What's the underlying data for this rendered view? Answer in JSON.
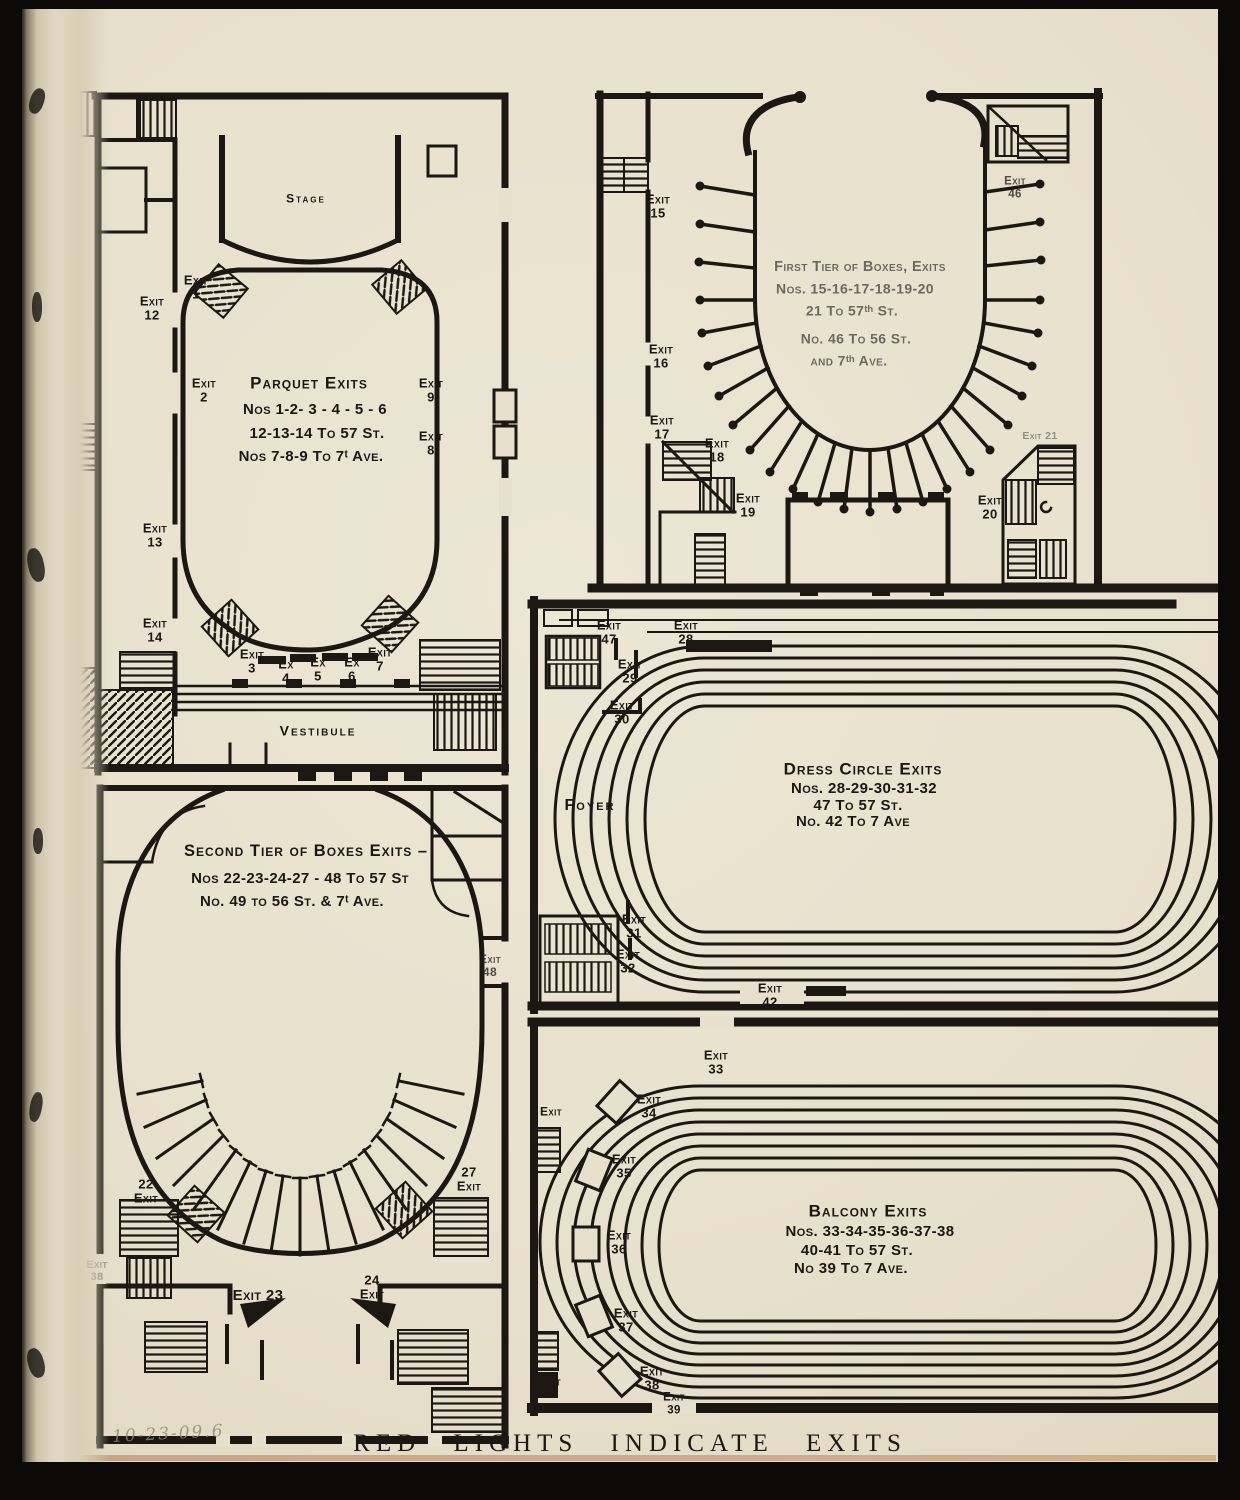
{
  "page": {
    "caption": "RED LIGHTS INDICATE EXITS",
    "pencil_note": "10-23-09.6"
  },
  "parquet": {
    "stage": "Stage",
    "title": "Parquet Exits",
    "note1": "Nos 1-2- 3 - 4 - 5 - 6",
    "note2": "12-13-14 To 57 St.",
    "note3": "Nos 7-8-9  To 7ᵗ Ave.",
    "vestibule": "Vestibule",
    "exits": {
      "e1": "Exit\n1",
      "e2": "Exit\n2",
      "e3": "Exit\n3",
      "ex4": "Ex\n4",
      "ex5": "Ex\n5",
      "ex6": "Ex\n6",
      "e7": "Exit\n7",
      "e8": "Exit\n8",
      "e9": "Exit\n9",
      "e12": "Exit\n12",
      "e13": "Exit\n13",
      "e14": "Exit\n14"
    }
  },
  "first_tier": {
    "title": "First Tier of Boxes, Exits",
    "note1": "Nos. 15-16-17-18-19-20",
    "note2": "21 To 57ᵗʰ St.",
    "note3": "No.  46 To 56 St.",
    "note4": "and 7ᵗʰ Ave.",
    "exits": {
      "e15": "Exit\n15",
      "e16": "Exit\n16",
      "e17": "Exit\n17",
      "e18": "Exit\n18",
      "e19": "Exit\n19",
      "e20": "Exit\n20",
      "e21": "Exit 21",
      "e46": "Exit\n46"
    }
  },
  "second_tier": {
    "title": "Second Tier of Boxes  Exits –",
    "note1": "Nos 22-23-24-27 - 48 To 57 St",
    "note2": "No.   49 to 56 St. & 7ᵗ Ave.",
    "exits": {
      "e22": "22\nExit",
      "e23": "Exit 23",
      "e24": "24\nExit",
      "e27": "27\nExit",
      "e48": "Exit\n48",
      "e38s": "Exit\n38"
    }
  },
  "dress_circle": {
    "title": "Dress Circle Exits",
    "note1": "Nos. 28-29-30-31-32",
    "note2": "47 To 57 St.",
    "note3": "No. 42 To  7 Ave",
    "foyer": "Foyer",
    "exits": {
      "e28": "Exit\n28",
      "e29": "Exit\n29",
      "e30": "Exit\n30",
      "e31": "Exit\n31",
      "e32": "Exit\n32",
      "e42": "Exit\n42",
      "e47": "Exit\n47"
    }
  },
  "balcony": {
    "title": "Balcony Exits",
    "note1": "Nos. 33-34-35-36-37-38",
    "note2": "40-41 To 57 St.",
    "note3": "No 39 To 7 Ave.",
    "exits": {
      "e33": "Exit\n33",
      "e34": "Exit\n34",
      "e35": "Exit\n35",
      "e36": "Exit\n36",
      "e37": "Exit\n37",
      "e38": "Exit\n38",
      "e39": "Exit\n39",
      "eL1": "Exit",
      "eL2": "Exit"
    }
  }
}
